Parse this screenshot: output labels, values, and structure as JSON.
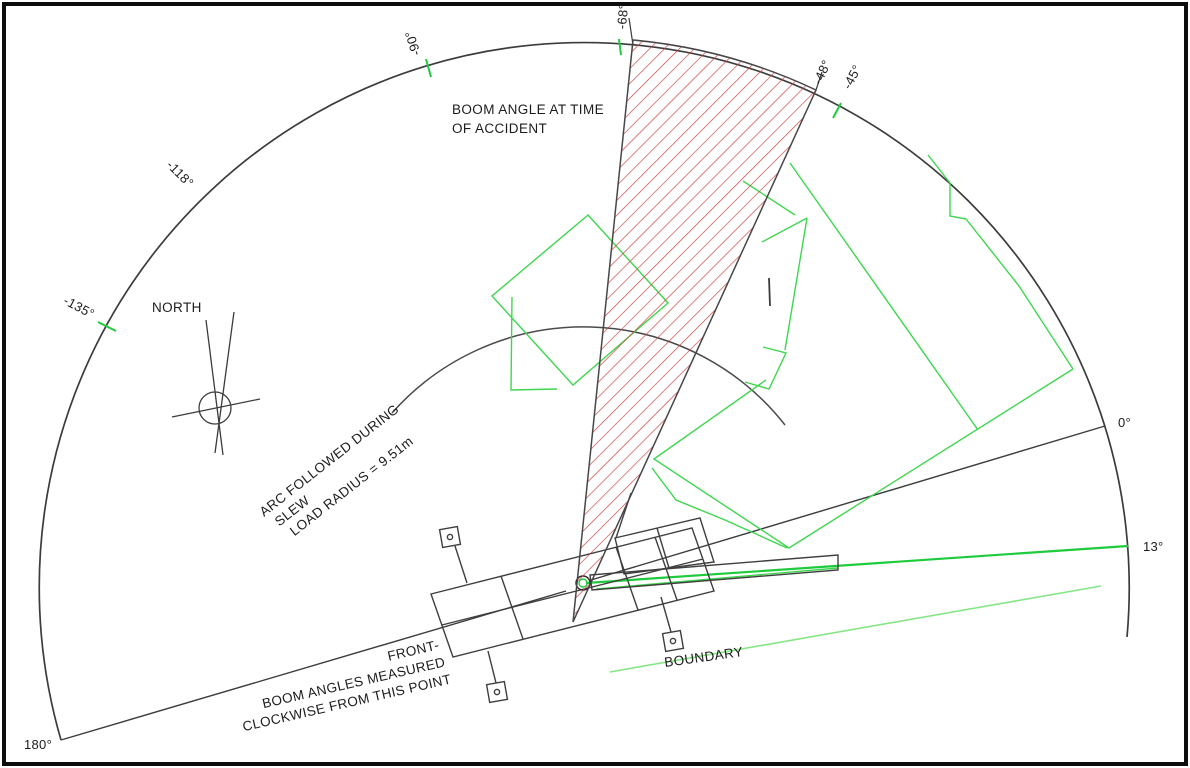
{
  "diagram": {
    "type": "crane-accident-site-plan",
    "notes": {
      "boom_angle": [
        "BOOM ANGLE AT TIME",
        "OF ACCIDENT"
      ],
      "arc": [
        "ARC FOLLOWED DURING",
        "SLEW",
        "LOAD RADIUS = 9.51m"
      ],
      "front": [
        "FRONT-",
        "BOOM ANGLES MEASURED",
        "CLOCKWISE FROM THIS POINT"
      ],
      "boundary": "BOUNDARY",
      "north": "NORTH"
    },
    "angle_labels": [
      "-68°",
      "-90°",
      "-118°",
      "-135°",
      "-48°",
      "-45°",
      "0°",
      "13°",
      "180°"
    ],
    "measurements": {
      "load_radius": "9.51m",
      "accident_wedge_from": "-68°",
      "accident_wedge_to": "-48°"
    },
    "colors": {
      "site_outline_green": "#3fd64f",
      "boundary_green": "#86e686",
      "slew_line_green": "#1ecb3c",
      "accident_hatch_red": "#cc3b3b",
      "drawing_line": "#3c3c3c"
    }
  }
}
